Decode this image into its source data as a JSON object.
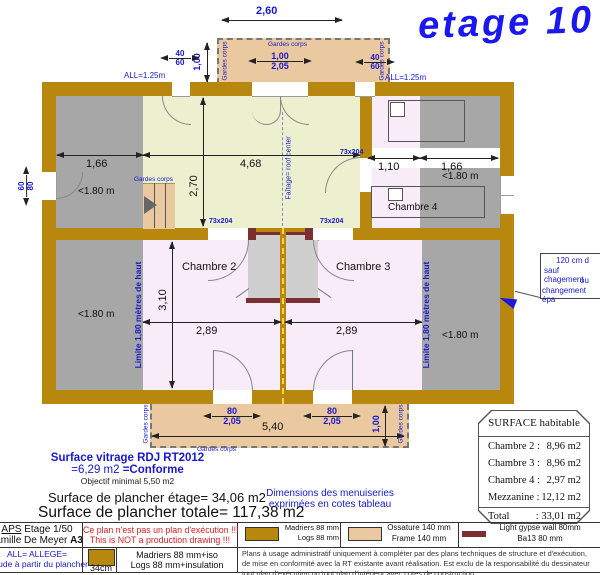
{
  "title": "etage 10",
  "plan": {
    "dims": {
      "w260": "2,60",
      "h100": "1,00",
      "w40": "40",
      "h60": "60",
      "door_w": "1,00",
      "door_h": "2,05",
      "all_left": "ALL=1.25m",
      "all_right": "ALL=1.25m",
      "win60": "60",
      "win80": "80",
      "left166": "1,66",
      "mezz468": "4,68",
      "mezz270": "2,70",
      "right110": "1,10",
      "right166": "1,66",
      "c2_310": "3,10",
      "c2_289": "2,89",
      "c3_289": "2,89",
      "door73": "73x204",
      "bdoor_w": "80",
      "bdoor_h": "2,05",
      "balc540": "5,40",
      "balc100": "1,00"
    },
    "labels": {
      "under180": "<1.80 m",
      "chambre2": "Chambre 2",
      "chambre3": "Chambre 3",
      "chambre4": "Chambre 4",
      "gardes": "Gardes corps",
      "limite": "Limite 1,80 mètres de haut",
      "faitage": "Faîtage= roof center"
    },
    "callout": [
      "120 cm d",
      "sauf chagement",
      "ou",
      "changement épa"
    ]
  },
  "surface_table": {
    "header": "SURFACE habitable",
    "rows": [
      {
        "label": "Chambre 2 :",
        "value": "8,96 m2"
      },
      {
        "label": "Chambre 3 :",
        "value": "8,96 m2"
      },
      {
        "label": "Chambre 4 :",
        "value": "2,97 m2"
      },
      {
        "label": "Mezzanine :",
        "value": "12,12 m2"
      }
    ],
    "total_label": "Total",
    "total_value": ": 33,01 m2"
  },
  "notes": {
    "vitrage1": "Surface vitrage RDJ RT2012",
    "vitrage2a": "=6,29 m2 ",
    "vitrage2b": "=Conforme",
    "vitrage3": "Objectif minimal 5,50 m2",
    "etage_area": "Surface de plancher étage= 34,06 m2",
    "total_area": "Surface de plancher totale= 117,38 m2",
    "menu1": "Dimensions des menuiseries",
    "menu2": "exprimées en cotes tableau"
  },
  "footer": {
    "aps": "APS",
    "aps_rest": " Etage 1/50",
    "family": "Famille De Meyer ",
    "family_bold": "A3",
    "warn1": "Ce plan n'est pas un plan d'exécution !!!",
    "warn2": "This is NOT a production drawing !!!",
    "allege1": "ALL= ALLEGE=",
    "allege2": "Altitude à partir du plancher",
    "cm": "34cm",
    "mad1": "Madriers 88 mm+iso",
    "mad2": "Logs 88 mm+insulation",
    "legend": [
      {
        "l1": "Madriers 88 mm",
        "l2": "Logs 88 mm"
      },
      {
        "l1": "Ossature 140 mm",
        "l2": "Frame 140 mm"
      },
      {
        "l1": "Light gypse wall 80mm",
        "l2": "Ba13 80 mm"
      }
    ],
    "disclaimer": "Plans à usage administratif uniquement à compléter par des plans techniques de structure et d'exécution, de mise en conformité avec la RT existante avant réalisation. Est exclu de la  responsabilité du dessinateur tout plan d'exécution ou tout plan d'intérieur avec cotes de construction"
  }
}
